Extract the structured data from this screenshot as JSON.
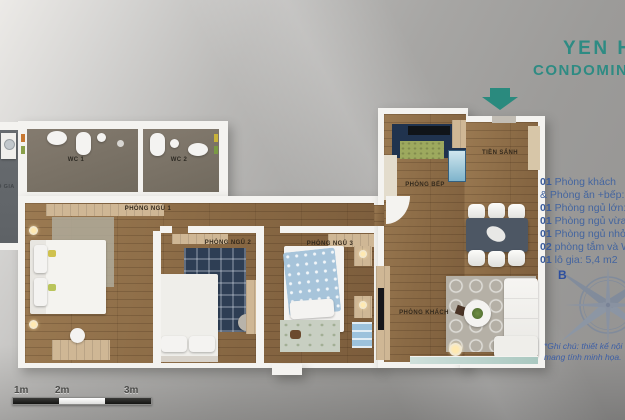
{
  "title": {
    "line1": "YEN HOA",
    "line2": "CONDOMINIUM"
  },
  "rooms": {
    "wc1": "WC 1",
    "wc2": "WC 2",
    "bedroom1": "PHÒNG NGỦ 1",
    "bedroom2": "PHÒNG NGỦ 2",
    "bedroom3": "PHÒNG NGỦ 3",
    "kitchen": "PHÒNG BẾP",
    "hall": "TIỀN SẢNH",
    "living": "PHÒNG KHÁCH",
    "balcony": "LÔ GIA"
  },
  "legend": {
    "lines": [
      {
        "num": "01",
        "text": "Phòng khách"
      },
      {
        "num": "",
        "text": "& Phòng ăn +bếp: 33,"
      },
      {
        "num": "01",
        "text": "Phòng ngủ lớn: 19"
      },
      {
        "num": "01",
        "text": "Phòng ngủ vừa: 15"
      },
      {
        "num": "01",
        "text": "Phòng ngủ nhỏ: 11"
      },
      {
        "num": "02",
        "text": "phòng tắm và WC"
      },
      {
        "num": "01",
        "text": "lô gia: 5,4 m2"
      }
    ]
  },
  "note": {
    "line1": "*Ghi chú: thiết kế nội thất",
    "line2": "mang tính minh họa."
  },
  "compass": {
    "label": "B"
  },
  "scale_bar": {
    "labels": [
      "1m",
      "2m",
      "3m"
    ]
  },
  "colors": {
    "accent_teal": "#2a8a7e",
    "legend_blue": "#44659f",
    "wall_white": "#f4f3f0",
    "wood": "#8a6a45",
    "wc_floor": "#7b7266"
  }
}
